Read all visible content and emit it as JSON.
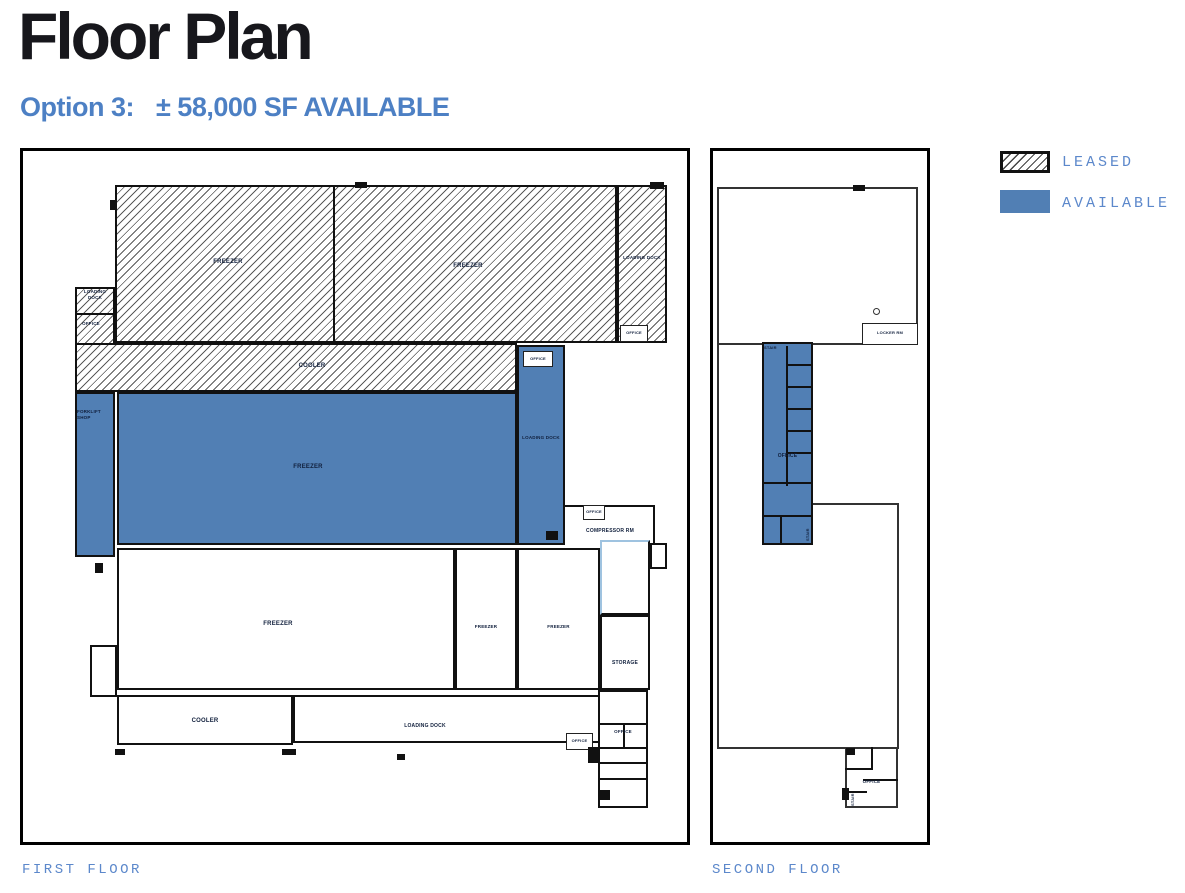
{
  "header": {
    "title": "Floor Plan",
    "option_label": "Option 3:",
    "availability": "± 58,000 SF AVAILABLE"
  },
  "legend": {
    "items": [
      {
        "label": "LEASED",
        "swatch": "hatched"
      },
      {
        "label": "AVAILABLE",
        "swatch": "solid"
      }
    ]
  },
  "colors": {
    "available_fill": "#517FB4",
    "legend_text_blue": "#5C88CB",
    "subtitle_blue": "#4D80C4",
    "title_black": "#17171C",
    "wall_black": "#111111"
  },
  "first_floor": {
    "caption": "FIRST FLOOR",
    "labels": {
      "freezer_nw": "FREEZER",
      "freezer_ne": "FREEZER",
      "loading_dock_e": "LOADING DOCK",
      "loading_dock_w": "LOADING DOCK",
      "office_w": "OFFICE",
      "cooler_mid": "COOLER",
      "forklift_shop": "FORKLIFT SHOP",
      "freezer_available": "FREEZER",
      "loading_dock_available": "LOADING DOCK",
      "office_avail_dock": "OFFICE",
      "office_e_dock": "OFFICE",
      "office_compressor": "OFFICE",
      "compressor_rm": "COMPRESSOR RM",
      "freezer_s": "FREEZER",
      "freezer_s2": "FREEZER",
      "freezer_s3": "FREEZER",
      "storage": "STORAGE",
      "cooler_s": "COOLER",
      "loading_dock_s": "LOADING DOCK",
      "office_s1": "OFFICE",
      "office_s2": "OFFICE"
    }
  },
  "second_floor": {
    "caption": "SECOND FLOOR",
    "labels": {
      "locker_rm": "LOCKER RM",
      "stair_n": "STAIR",
      "office_strip": "OFFICE",
      "stair_mid": "STAIR",
      "office_cluster": "OFFICE",
      "stair_s": "STAIR"
    }
  }
}
